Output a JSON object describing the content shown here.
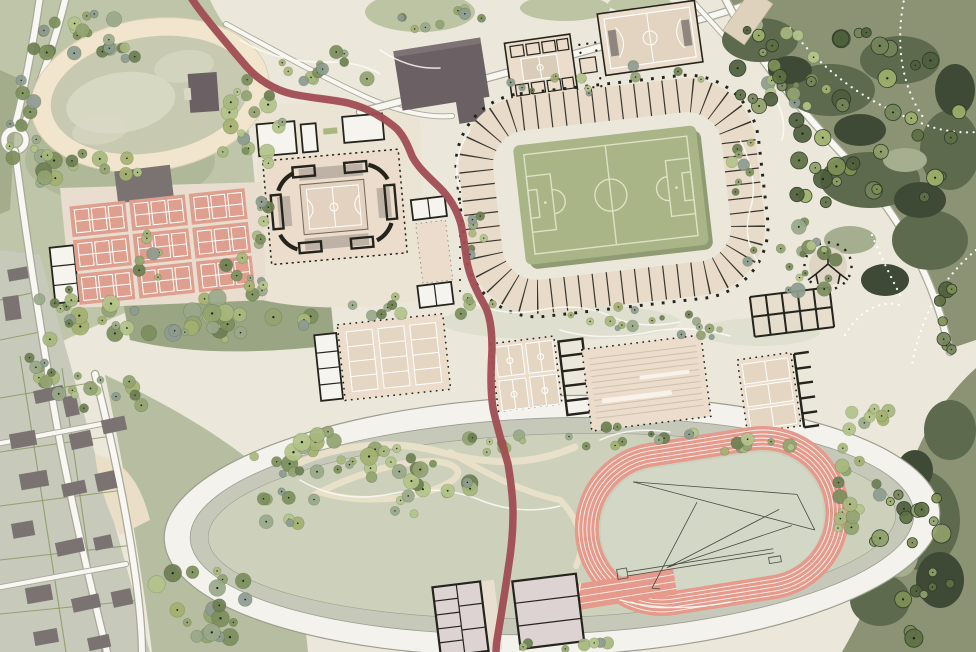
{
  "palette": {
    "ink": "#24241d",
    "base": "#ebe8db",
    "parkGreen": "#bfc5a8",
    "parkDark": "#a3ad8b",
    "midGreen": "#9aa584",
    "stripGreen": "#b7bda0",
    "lawn": "#b7c09c",
    "ovalCream": "#f1e5cd",
    "ovalIn": "#c7cab0",
    "ovalBlotch": "#d8d9c4",
    "bldDark": "#6b6064",
    "bldGray": "#7b7372",
    "hall": "#ebdccb",
    "hallCourt": "#e5d6c3",
    "roomW": "#f6f4ee",
    "stand": "#e8dbc9",
    "pitch": "#a9b487",
    "pitchLine": "#dce2c3",
    "pitchShadow": "#8f9b73",
    "courtSalmon": "#df9f8e",
    "trackSalmon": "#e59a8b",
    "trackLine": "#fbf1ee",
    "redPath": "#a04e54",
    "roadCase": "#a8a89b",
    "roadFill": "#f8f7f2",
    "ringW": "#f3f2ec",
    "ringG": "#c6c9ba",
    "infield": "#cdd1bb",
    "forest": "#8b9374",
    "forestDark": "#5d6a4d",
    "forestDarker": "#3f4a36",
    "forestLight": "#a5ae8e",
    "contour": "#fcfcf7",
    "blockPink": "#dcd3d2",
    "plaza": "#ded5c4",
    "beigePath": "#e9e0ca"
  },
  "features": {
    "site": "sports-park-master-plan",
    "items": [
      "trotting-oval",
      "tennis-courts",
      "indoor-arena",
      "football-stadium",
      "sports-halls",
      "athletics-track",
      "park-ring",
      "red-promenade",
      "forest",
      "residential-blocks"
    ]
  },
  "vegetation": {
    "palettes": {
      "p": [
        "#93a371",
        "#a8b87e",
        "#7c8f5c",
        "#b3c48a",
        "#6d7f52",
        "#9aa98a",
        "#8d9c90",
        "#a4b170"
      ],
      "f": [
        "#7f9057",
        "#5e7044",
        "#9eb06b",
        "#4e5f3d",
        "#8fa06a",
        "#74855b"
      ]
    },
    "clusters": [
      {
        "x": 95,
        "y": 38,
        "rx": 85,
        "ry": 26,
        "n": 24,
        "rmin": 3.5,
        "rmax": 8,
        "style": "p"
      },
      {
        "x": 28,
        "y": 125,
        "rx": 22,
        "ry": 50,
        "n": 12,
        "rmin": 3.5,
        "rmax": 8,
        "style": "p"
      },
      {
        "x": 80,
        "y": 170,
        "rx": 62,
        "ry": 18,
        "n": 14,
        "rmin": 3.5,
        "rmax": 8.5,
        "style": "p"
      },
      {
        "x": 252,
        "y": 122,
        "rx": 36,
        "ry": 52,
        "n": 18,
        "rmin": 3.5,
        "rmax": 8.5,
        "style": "p"
      },
      {
        "x": 330,
        "y": 68,
        "rx": 62,
        "ry": 20,
        "n": 13,
        "rmin": 3,
        "rmax": 7.5,
        "style": "p"
      },
      {
        "x": 195,
        "y": 320,
        "rx": 122,
        "ry": 24,
        "n": 34,
        "rmin": 3.5,
        "rmax": 9.5,
        "style": "p"
      },
      {
        "x": 52,
        "y": 306,
        "rx": 20,
        "ry": 36,
        "n": 9,
        "rmin": 3.5,
        "rmax": 8,
        "style": "p"
      },
      {
        "x": 262,
        "y": 216,
        "rx": 11,
        "ry": 36,
        "n": 8,
        "rmin": 3,
        "rmax": 6.5,
        "style": "p"
      },
      {
        "x": 472,
        "y": 254,
        "rx": 14,
        "ry": 50,
        "n": 8,
        "rmin": 3,
        "rmax": 6,
        "style": "p"
      },
      {
        "x": 600,
        "y": 80,
        "rx": 110,
        "ry": 15,
        "n": 12,
        "rmin": 2.5,
        "rmax": 5.5,
        "style": "p"
      },
      {
        "x": 640,
        "y": 318,
        "rx": 92,
        "ry": 12,
        "n": 12,
        "rmin": 2.5,
        "rmax": 6,
        "style": "p"
      },
      {
        "x": 420,
        "y": 307,
        "rx": 82,
        "ry": 12,
        "n": 11,
        "rmin": 3,
        "rmax": 6.5,
        "style": "p"
      },
      {
        "x": 795,
        "y": 257,
        "rx": 50,
        "ry": 40,
        "n": 20,
        "rmin": 3,
        "rmax": 8,
        "style": "p"
      },
      {
        "x": 332,
        "y": 460,
        "rx": 82,
        "ry": 30,
        "n": 28,
        "rmin": 3.5,
        "rmax": 9,
        "style": "p"
      },
      {
        "x": 432,
        "y": 492,
        "rx": 55,
        "ry": 30,
        "n": 16,
        "rmin": 3.5,
        "rmax": 8.5,
        "style": "p"
      },
      {
        "x": 292,
        "y": 508,
        "rx": 34,
        "ry": 22,
        "n": 9,
        "rmin": 3,
        "rmax": 7,
        "style": "p"
      },
      {
        "x": 492,
        "y": 443,
        "rx": 36,
        "ry": 16,
        "n": 9,
        "rmin": 3,
        "rmax": 7,
        "style": "p"
      },
      {
        "x": 642,
        "y": 437,
        "rx": 82,
        "ry": 13,
        "n": 11,
        "rmin": 3,
        "rmax": 7,
        "style": "p"
      },
      {
        "x": 762,
        "y": 443,
        "rx": 52,
        "ry": 12,
        "n": 9,
        "rmin": 3,
        "rmax": 7,
        "style": "p"
      },
      {
        "x": 852,
        "y": 492,
        "rx": 30,
        "ry": 50,
        "n": 15,
        "rmin": 3.5,
        "rmax": 8.5,
        "style": "p"
      },
      {
        "x": 558,
        "y": 643,
        "rx": 52,
        "ry": 9,
        "n": 7,
        "rmin": 3,
        "rmax": 6.5,
        "style": "p"
      },
      {
        "x": 95,
        "y": 390,
        "rx": 68,
        "ry": 22,
        "n": 15,
        "rmin": 3.5,
        "rmax": 8.5,
        "style": "p"
      },
      {
        "x": 205,
        "y": 603,
        "rx": 62,
        "ry": 40,
        "n": 20,
        "rmin": 3.5,
        "rmax": 9,
        "style": "p"
      },
      {
        "x": 35,
        "y": 373,
        "rx": 26,
        "ry": 16,
        "n": 7,
        "rmin": 3,
        "rmax": 7,
        "style": "p"
      },
      {
        "x": 445,
        "y": 20,
        "rx": 52,
        "ry": 15,
        "n": 9,
        "rmin": 3,
        "rmax": 7,
        "style": "p"
      },
      {
        "x": 800,
        "y": 73,
        "rx": 52,
        "ry": 42,
        "n": 13,
        "rmin": 3,
        "rmax": 8,
        "style": "p"
      },
      {
        "x": 248,
        "y": 273,
        "rx": 26,
        "ry": 24,
        "n": 9,
        "rmin": 3,
        "rmax": 7,
        "style": "p"
      },
      {
        "x": 700,
        "y": 333,
        "rx": 34,
        "ry": 8,
        "n": 6,
        "rmin": 2.5,
        "rmax": 5.5,
        "style": "p"
      },
      {
        "x": 872,
        "y": 420,
        "rx": 36,
        "ry": 14,
        "n": 9,
        "rmin": 3,
        "rmax": 7,
        "style": "p"
      },
      {
        "x": 150,
        "y": 247,
        "rx": 16,
        "ry": 36,
        "n": 7,
        "rmin": 3,
        "rmax": 7,
        "style": "p"
      },
      {
        "x": 740,
        "y": 150,
        "rx": 18,
        "ry": 45,
        "n": 8,
        "rmin": 3,
        "rmax": 6.5,
        "style": "p"
      },
      {
        "x": 862,
        "y": 128,
        "rx": 100,
        "ry": 100,
        "n": 36,
        "rmin": 4,
        "rmax": 9.5,
        "style": "f"
      },
      {
        "x": 758,
        "y": 64,
        "rx": 44,
        "ry": 44,
        "n": 12,
        "rmin": 4,
        "rmax": 8.5,
        "style": "f"
      },
      {
        "x": 918,
        "y": 565,
        "rx": 48,
        "ry": 78,
        "n": 20,
        "rmin": 4,
        "rmax": 9.5,
        "style": "f"
      },
      {
        "x": 952,
        "y": 322,
        "rx": 18,
        "ry": 36,
        "n": 7,
        "rmin": 4,
        "rmax": 8,
        "style": "f"
      }
    ]
  }
}
